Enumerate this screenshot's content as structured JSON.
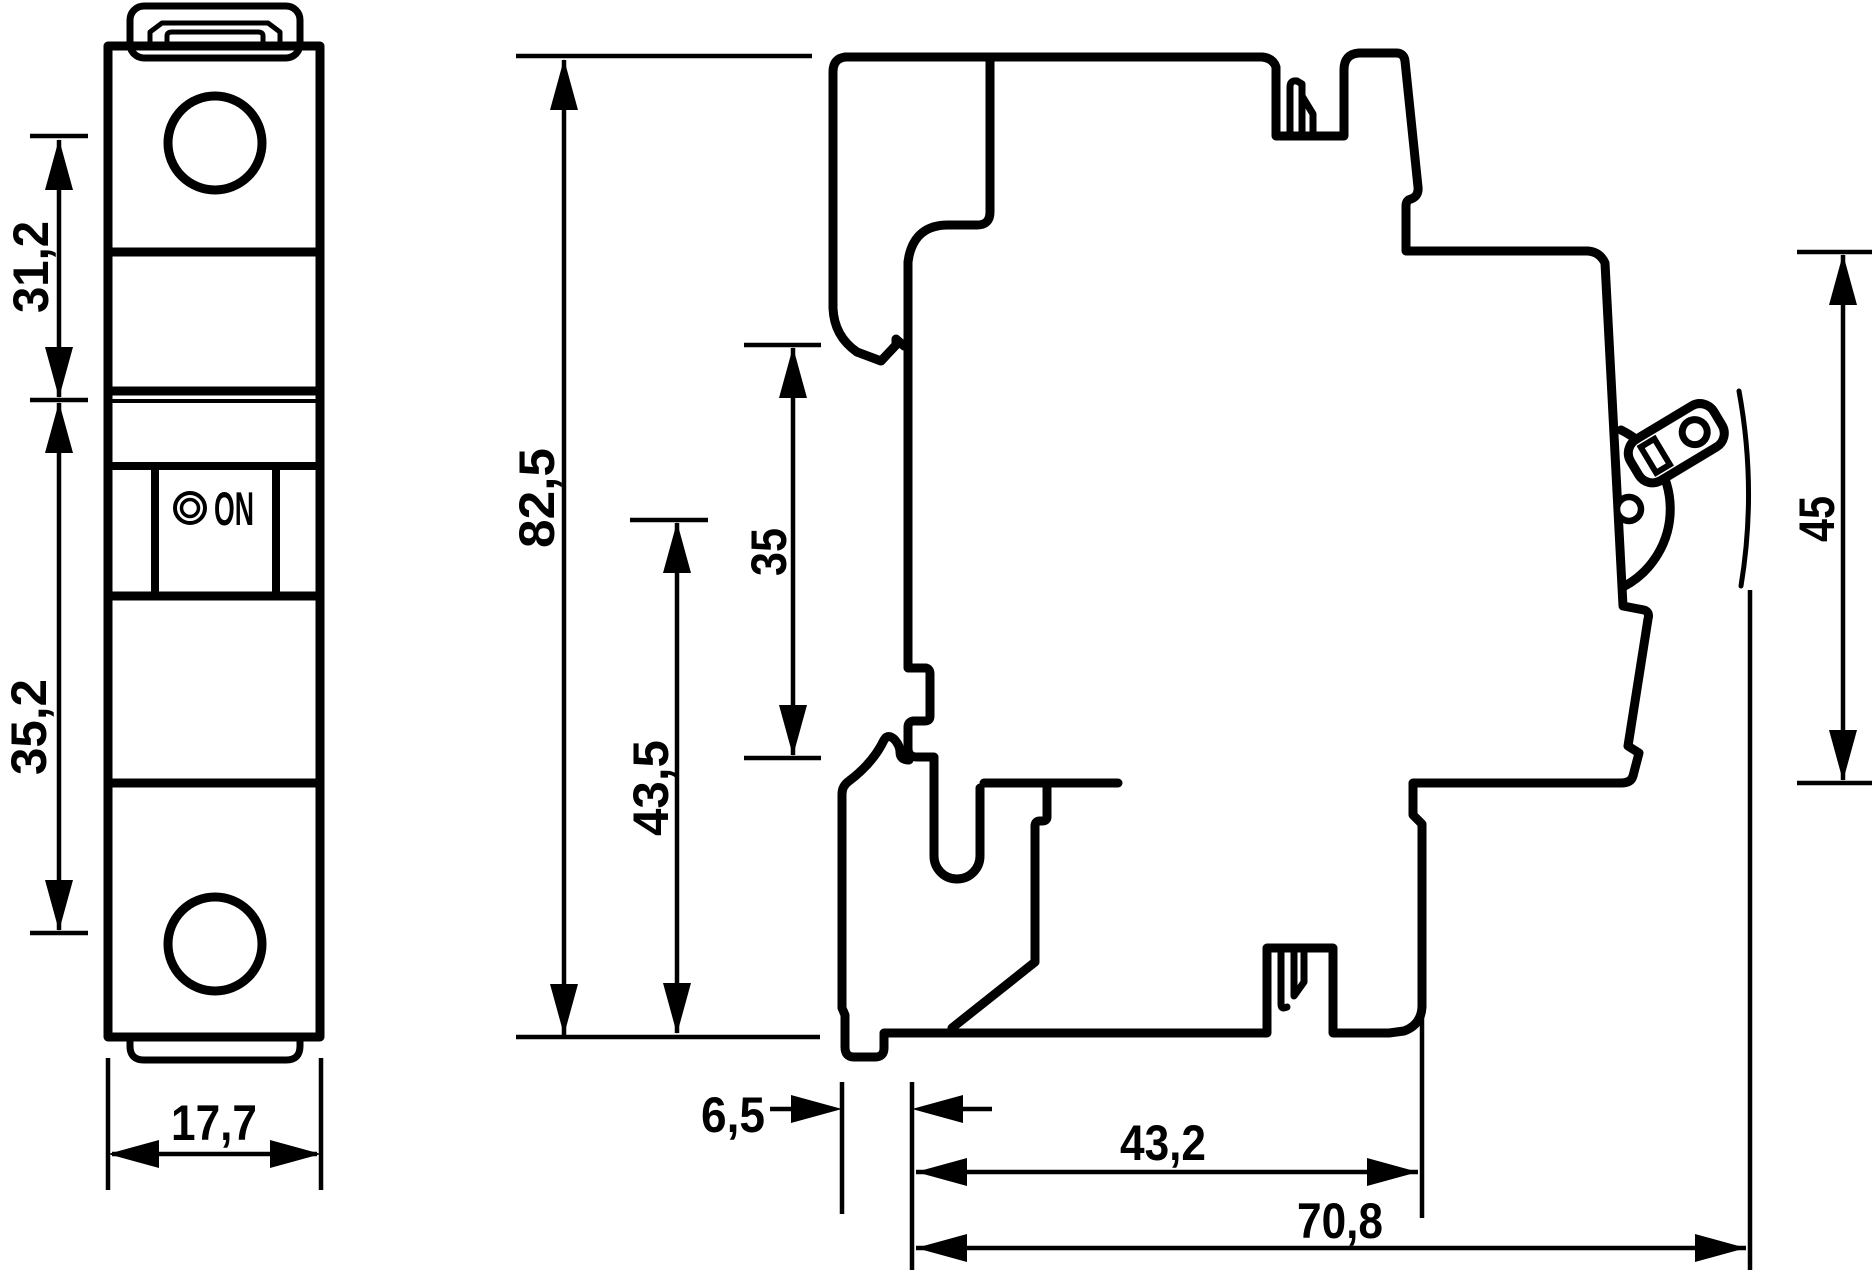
{
  "drawing_type": "circuit-breaker-dimension-drawing",
  "labels": {
    "switch_state": "ON"
  },
  "dimensions": {
    "front_upper": "31,2",
    "front_lower": "35,2",
    "front_width": "17,7",
    "side_height": "82,5",
    "side_43_5": "43,5",
    "din_rail": "35",
    "front_face_height": "45",
    "clip_offset": "6,5",
    "depth_body": "43,2",
    "depth_overall": "70,8"
  },
  "colors": {
    "line": "#000000",
    "background": "#ffffff"
  }
}
